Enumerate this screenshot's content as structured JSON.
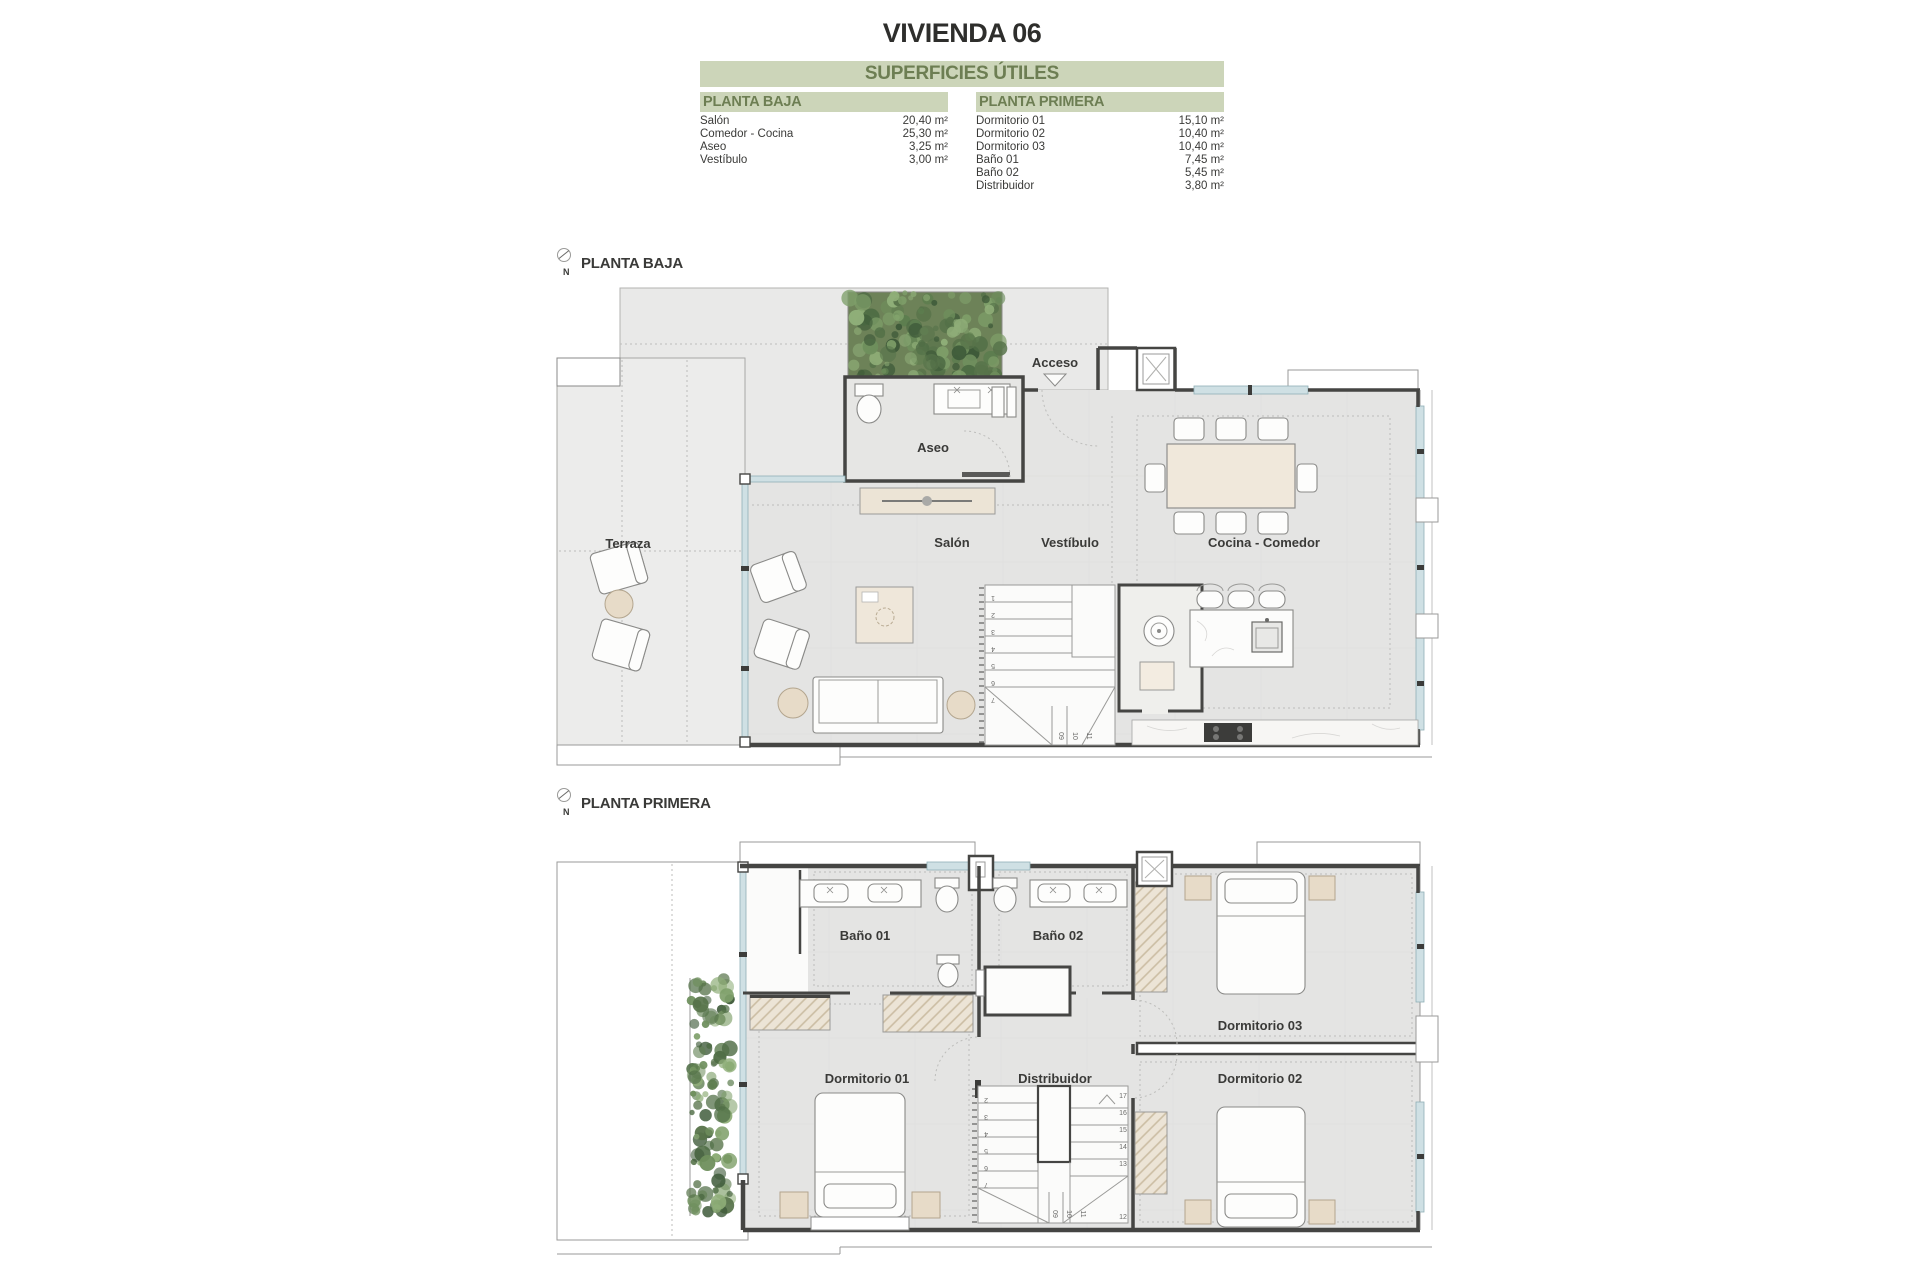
{
  "title": "VIVIENDA 06",
  "areas": {
    "header": "SUPERFICIES ÚTILES",
    "columns": [
      {
        "header": "PLANTA BAJA",
        "rows": [
          [
            "Salón",
            "20,40 m²"
          ],
          [
            "Comedor - Cocina",
            "25,30 m²"
          ],
          [
            "Aseo",
            "3,25 m²"
          ],
          [
            "Vestíbulo",
            "3,00 m²"
          ]
        ]
      },
      {
        "header": "PLANTA PRIMERA",
        "rows": [
          [
            "Dormitorio 01",
            "15,10 m²"
          ],
          [
            "Dormitorio 02",
            "10,40 m²"
          ],
          [
            "Dormitorio 03",
            "10,40 m²"
          ],
          [
            "Baño 01",
            "7,45 m²"
          ],
          [
            "Baño 02",
            "5,45 m²"
          ],
          [
            "Distribuidor",
            "3,80 m²"
          ]
        ]
      }
    ]
  },
  "plans": [
    {
      "label": "PLANTA BAJA",
      "north": "N",
      "rooms": {
        "terraza": "Terraza",
        "aseo": "Aseo",
        "acceso": "Acceso",
        "salon": "Salón",
        "vestibulo": "Vestíbulo",
        "cocina": "Cocina - Comedor"
      },
      "stairs": {
        "main": [
          "1",
          "2",
          "3",
          "4",
          "5",
          "6",
          "7"
        ],
        "turn": [
          "09",
          "10",
          "11"
        ]
      }
    },
    {
      "label": "PLANTA PRIMERA",
      "north": "N",
      "rooms": {
        "bano1": "Baño 01",
        "bano2": "Baño 02",
        "dorm1": "Dormitorio 01",
        "distribuidor": "Distribuidor",
        "dorm3": "Dormitorio 03",
        "dorm2": "Dormitorio 02"
      },
      "stairs": {
        "left": [
          "2",
          "3",
          "4",
          "5",
          "6",
          "7"
        ],
        "right": [
          "17",
          "16",
          "15",
          "14",
          "13"
        ],
        "bottom": [
          "09",
          "10",
          "11"
        ],
        "last": "12"
      }
    }
  ],
  "colors": {
    "accent_bar": "#ccd5b9",
    "accent_text": "#6d7e53",
    "wall": "#454543",
    "glazing": "#cfe0e4"
  }
}
